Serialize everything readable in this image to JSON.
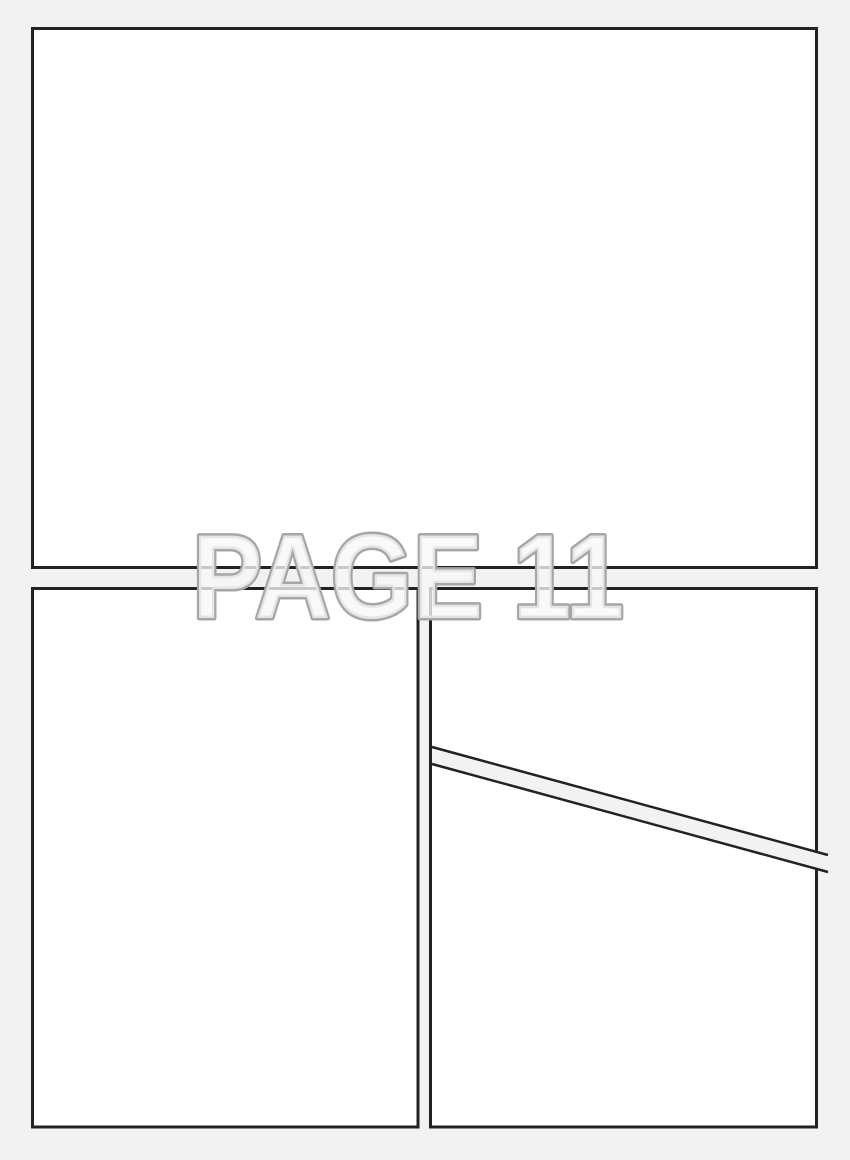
{
  "page": {
    "label": {
      "text": "PAGE 11"
    },
    "colors": {
      "background": "#f2f2f2",
      "panel_fill": "#ffffff",
      "panel_border": "#222222",
      "gutter_fill": "#f2f2f2",
      "label_fill": "#f7f7f7",
      "label_outline": "#a6a6a6"
    },
    "panels": [
      {
        "position": "top",
        "shape": "rectangle"
      },
      {
        "position": "bottom-left",
        "shape": "rectangle"
      },
      {
        "position": "middle-right",
        "shape": "quad-slanted-bottom"
      },
      {
        "position": "bottom-right",
        "shape": "quad-slanted-top"
      }
    ]
  }
}
